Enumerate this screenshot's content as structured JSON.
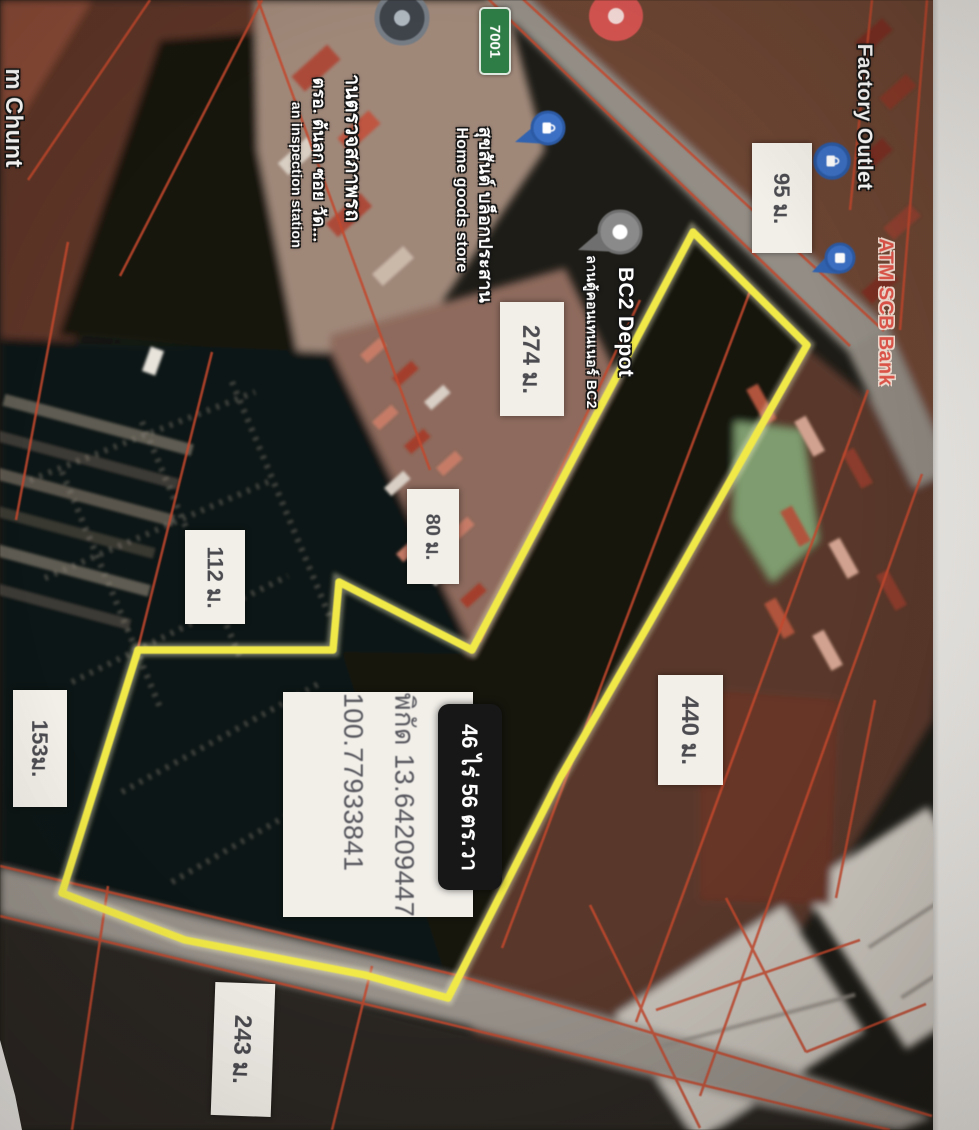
{
  "map": {
    "measurements": [
      {
        "text": "95 ม."
      },
      {
        "text": "274 ม."
      },
      {
        "text": "80 ม."
      },
      {
        "text": "112 ม."
      },
      {
        "text": "153ม."
      },
      {
        "text": "440 ม."
      },
      {
        "text": "243 ม."
      }
    ],
    "area_badge": {
      "text": "46 ไร่ 56 ตร.วา"
    },
    "coordinate_box": {
      "line_1": "พิกัด 13.64209447",
      "line_2": "100.77933841"
    },
    "road_badge": {
      "text": "7001"
    },
    "pois": {
      "factory_outlet": {
        "label": "Factory Outlet"
      },
      "atm_scb": {
        "label": "ATM SCB Bank"
      },
      "home_goods": {
        "label_thai": "สุขสันต์ บล็อกประสาน",
        "label_en": "Home goods store"
      },
      "bc2_depot": {
        "label": "BC2 Depot",
        "label_thai": "ลานตู้คอนเทนเนอร์ BC2"
      },
      "inspection_station": {
        "label_thai_1": "านตรวจสภาพรถ",
        "label_thai_2": "ตรอ. ต้นลก ซอย วัด...",
        "label_en": "an inspection station"
      },
      "partial_left": {
        "label": "m Chunt"
      }
    },
    "pins": [
      {
        "name": "shopping-pin-blue",
        "color": "#3a70c9"
      },
      {
        "name": "atm-pin-blue",
        "color": "#3a70c9"
      },
      {
        "name": "store-pin-blue",
        "color": "#3a70c9"
      },
      {
        "name": "bc2-depot-pin-gray",
        "color": "#8a8a8a"
      },
      {
        "name": "restaurant-pin-red",
        "color": "#d9534f"
      },
      {
        "name": "place-pin-dark",
        "color": "#3f444b"
      }
    ]
  },
  "theme": {
    "plot-yellow": "#f2ea3f",
    "cadastral-red": "#c8472b",
    "label-bg": "#f2efe9",
    "label-text": "#4b4b50",
    "area-badge-bg": "#171717",
    "area-badge-text": "#ffffff",
    "poi-white": "#ffffff",
    "poi-outline": "#151515",
    "atm-red": "#e0554a",
    "badge-green": "#2f7d46",
    "strip-white": "#eceae6"
  }
}
